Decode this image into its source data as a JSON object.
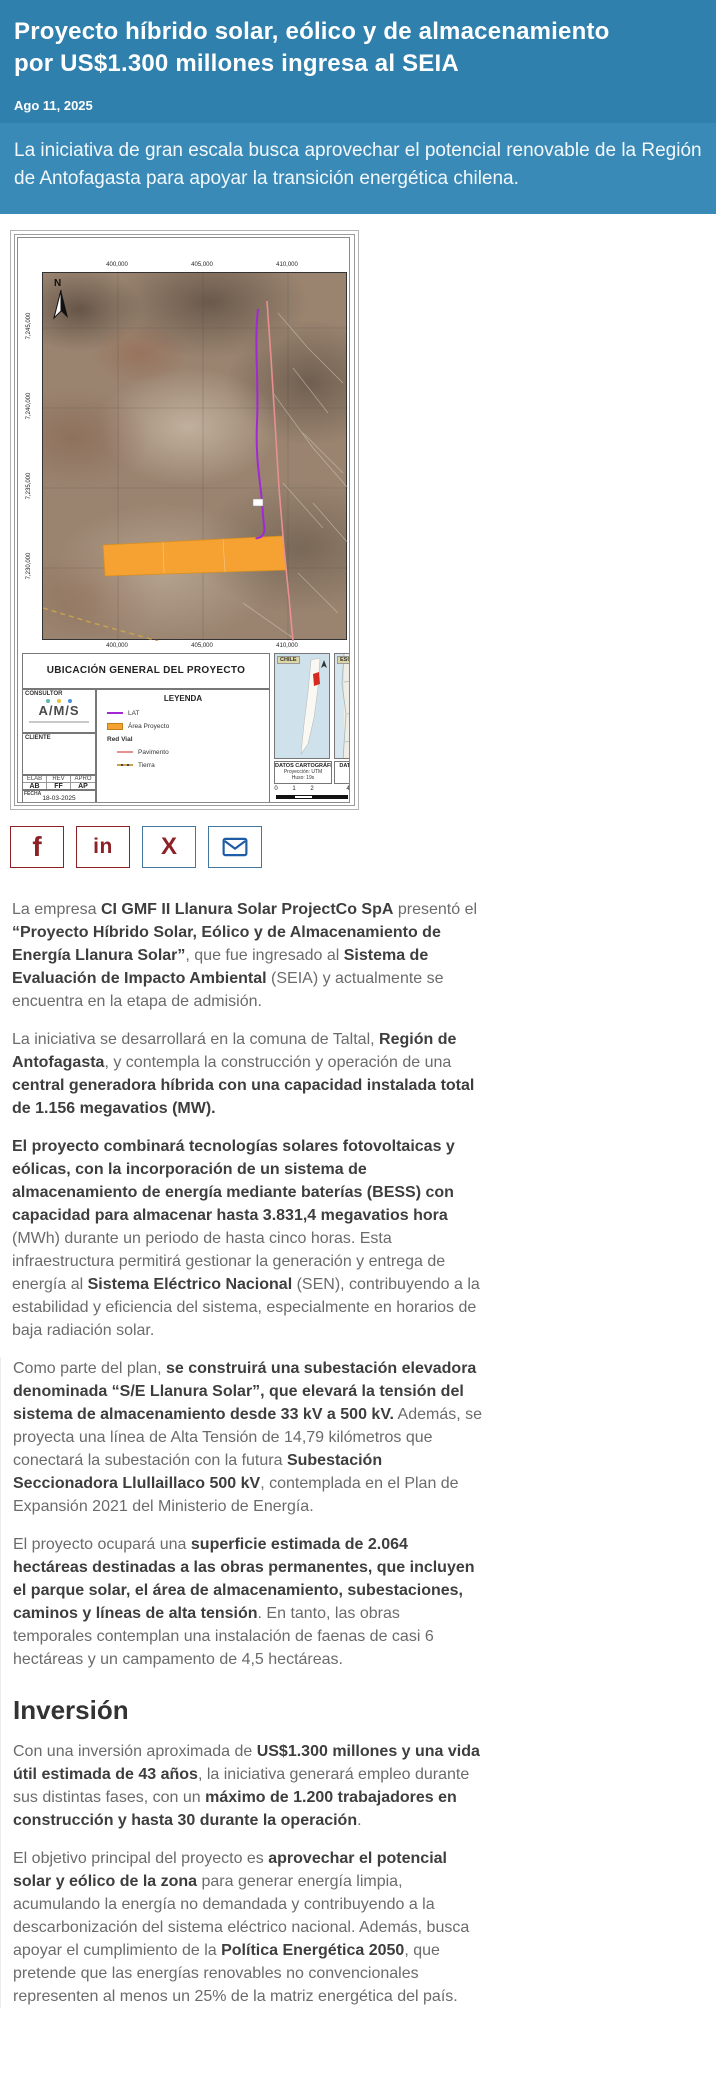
{
  "header": {
    "title": "Proyecto híbrido solar, eólico y de almacenamiento por US$1.300 millones ingresa al SEIA",
    "date": "Ago 11, 2025",
    "subtitle": "La iniciativa de gran escala busca aprovechar el potencial renovable de la Región de Antofagasta para apoyar la transición energética chilena.",
    "bg_color": "#2F80AD",
    "subtitle_bg_color": "#3A8AB7"
  },
  "map": {
    "title_block": "UBICACIÓN GENERAL DEL PROYECTO",
    "north_label": "N",
    "top_coords": [
      "400,000",
      "405,000",
      "410,000",
      "415,000"
    ],
    "bottom_coords": [
      "400,000",
      "405,000",
      "410,000"
    ],
    "left_coords": [
      "7,245,000",
      "7,240,000",
      "7,235,000",
      "7,230,000"
    ],
    "consultor": {
      "label": "CONSULTOR",
      "logo": "A/M/S"
    },
    "cliente_label": "CLIENTE",
    "legend": {
      "title": "LEYENDA",
      "items": [
        {
          "label": "LAT",
          "swatch": "line-purple",
          "bold": false,
          "indent": false
        },
        {
          "label": "Área Proyecto",
          "swatch": "fill-orange",
          "bold": false,
          "indent": false
        },
        {
          "label": "Red Vial",
          "swatch": "none",
          "bold": true,
          "indent": false
        },
        {
          "label": "Pavimento",
          "swatch": "line-pink",
          "bold": false,
          "indent": true
        },
        {
          "label": "Tierra",
          "swatch": "line-dashed",
          "bold": false,
          "indent": true
        }
      ]
    },
    "approvals": {
      "headers": [
        "ELAB",
        "REV",
        "APRO"
      ],
      "values": [
        "AB",
        "FF",
        "AP"
      ]
    },
    "fecha_label": "FECHA",
    "fecha": "18-03-2025",
    "insets": {
      "chile": "CHILE",
      "esquema": "ESQUEMA PROVINCIAL"
    },
    "datos_cartograficos": {
      "title": "DATOS CARTOGRÁFICOS",
      "lines": [
        "Proyección: UTM",
        "Huso: 19s"
      ]
    },
    "datos_geodesicos": {
      "title": "DATOS GEODÉSICOS"
    },
    "scale_ticks": [
      "0",
      "1",
      "2",
      "4"
    ],
    "colors": {
      "lat_line": "#A128D6",
      "project_area": "#F5A233",
      "pavimento_line": "#E89090",
      "terrain": "#9A8470"
    }
  },
  "share": {
    "buttons": [
      {
        "name": "facebook",
        "glyph": "f",
        "color": "#8C2127",
        "border": "#8C2127"
      },
      {
        "name": "linkedin",
        "glyph": "in",
        "color": "#8C2127",
        "border": "#8C2127"
      },
      {
        "name": "x-twitter",
        "glyph": "X",
        "color": "#8C2127",
        "border": "#44779E"
      },
      {
        "name": "email",
        "glyph": "envelope",
        "color": "#1F5CA6",
        "border": "#44779E"
      }
    ]
  },
  "article": {
    "intro_sections": [
      {
        "type": "p",
        "runs": [
          {
            "t": "La empresa ",
            "b": false
          },
          {
            "t": "CI GMF II Llanura Solar ProjectCo SpA",
            "b": true
          },
          {
            "t": " presentó el ",
            "b": false
          },
          {
            "t": "“Proyecto Híbrido Solar, Eólico y de Almacenamiento de Energía Llanura Solar”",
            "b": true
          },
          {
            "t": ", que fue ingresado al ",
            "b": false
          },
          {
            "t": "Sistema de Evaluación de Impacto Ambiental",
            "b": true
          },
          {
            "t": " (SEIA) y actualmente se encuentra en la etapa de admisión.",
            "b": false
          }
        ]
      },
      {
        "type": "p",
        "runs": [
          {
            "t": "La iniciativa se desarrollará en la comuna de Taltal, ",
            "b": false
          },
          {
            "t": "Región de Antofagasta",
            "b": true
          },
          {
            "t": ", y contempla la construcción y operación de una ",
            "b": false
          },
          {
            "t": "central generadora híbrida con una capacidad instalada total de 1.156 megavatios (MW).",
            "b": true
          }
        ]
      },
      {
        "type": "p",
        "runs": [
          {
            "t": "El proyecto combinará tecnologías solares fotovoltaicas y eólicas, con la incorporación de un sistema de almacenamiento de energía mediante baterías (BESS) con capacidad para almacenar hasta 3.831,4 megavatios hora",
            "b": true
          },
          {
            "t": " (MWh) durante un periodo de hasta cinco horas. Esta infraestructura permitirá gestionar la generación y entrega de energía al ",
            "b": false
          },
          {
            "t": "Sistema Eléctrico Nacional",
            "b": true
          },
          {
            "t": " (SEN), contribuyendo a la estabilidad y eficiencia del sistema, especialmente en horarios de baja radiación solar.",
            "b": false
          }
        ]
      }
    ],
    "main_sections": [
      {
        "type": "p",
        "runs": [
          {
            "t": "Como parte del plan, ",
            "b": false
          },
          {
            "t": "se construirá una subestación elevadora denominada “S/E Llanura Solar”, que elevará la tensión del sistema de almacenamiento desde 33 kV a 500 kV.",
            "b": true
          },
          {
            "t": " Además, se proyecta una línea de Alta Tensión de 14,79 kilómetros que conectará la subestación con la futura ",
            "b": false
          },
          {
            "t": "Subestación Seccionadora Llullaillaco 500 kV",
            "b": true
          },
          {
            "t": ", contemplada en el Plan de Expansión 2021 del Ministerio de Energía.",
            "b": false
          }
        ]
      },
      {
        "type": "p",
        "runs": [
          {
            "t": "El proyecto ocupará una ",
            "b": false
          },
          {
            "t": "superficie estimada de 2.064 hectáreas destinadas a las obras permanentes, que incluyen el parque solar, el área de almacenamiento, subestaciones, caminos y líneas de alta tensión",
            "b": true
          },
          {
            "t": ". En tanto, las obras temporales contemplan una instalación de faenas de casi 6 hectáreas y un campamento de 4,5 hectáreas.",
            "b": false
          }
        ]
      },
      {
        "type": "h2",
        "text": "Inversión"
      },
      {
        "type": "p",
        "runs": [
          {
            "t": "Con una inversión aproximada de ",
            "b": false
          },
          {
            "t": "US$1.300 millones y una vida útil estimada de 43 años",
            "b": true
          },
          {
            "t": ", la iniciativa generará empleo durante sus distintas fases, con un ",
            "b": false
          },
          {
            "t": "máximo de 1.200 trabajadores en construcción y hasta 30 durante la operación",
            "b": true
          },
          {
            "t": ".",
            "b": false
          }
        ]
      },
      {
        "type": "p",
        "runs": [
          {
            "t": "El objetivo principal del proyecto es ",
            "b": false
          },
          {
            "t": "aprovechar el potencial solar y eólico de la zona",
            "b": true
          },
          {
            "t": " para generar energía limpia, acumulando la energía no demandada y contribuyendo a la descarbonización del sistema eléctrico nacional. Además, busca apoyar el cumplimiento de la ",
            "b": false
          },
          {
            "t": "Política Energética 2050",
            "b": true
          },
          {
            "t": ", que pretende que las energías renovables no convencionales representen al menos un 25% de la matriz energética del país.",
            "b": false
          }
        ]
      }
    ]
  }
}
